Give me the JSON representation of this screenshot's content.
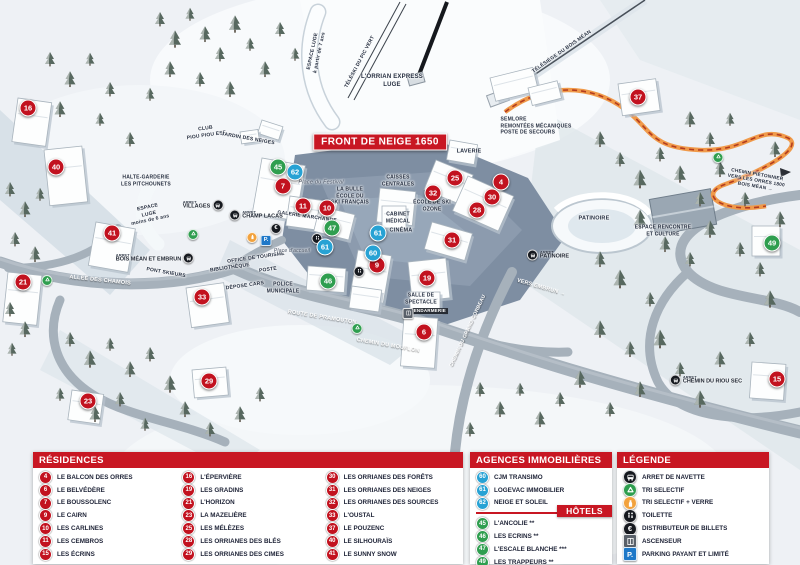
{
  "colors": {
    "residence": "#c2121f",
    "agency": "#27a2d4",
    "hotel": "#2f9e4f",
    "header_red": "#c81723",
    "icon_black": "#16191f",
    "icon_orange": "#f2a23d",
    "icon_grey": "#596069",
    "icon_parking_blue": "#1e78c8",
    "recycle_green": "#2f9e4f",
    "orange_path": "#f09a4a"
  },
  "map": {
    "banner": "FRONT DE NEIGE 1650",
    "arret_label": "ARRET",
    "markers": [
      {
        "num": "16",
        "type": "residence",
        "x": 28,
        "y": 108
      },
      {
        "num": "40",
        "type": "residence",
        "x": 56,
        "y": 167
      },
      {
        "num": "41",
        "type": "residence",
        "x": 112,
        "y": 233
      },
      {
        "num": "21",
        "type": "residence",
        "x": 23,
        "y": 282
      },
      {
        "num": "33",
        "type": "residence",
        "x": 202,
        "y": 297
      },
      {
        "num": "23",
        "type": "residence",
        "x": 88,
        "y": 401
      },
      {
        "num": "29",
        "type": "residence",
        "x": 209,
        "y": 381
      },
      {
        "num": "7",
        "type": "residence",
        "x": 283,
        "y": 186
      },
      {
        "num": "11",
        "type": "residence",
        "x": 303,
        "y": 206
      },
      {
        "num": "10",
        "type": "residence",
        "x": 327,
        "y": 208
      },
      {
        "num": "9",
        "type": "residence",
        "x": 377,
        "y": 265
      },
      {
        "num": "19",
        "type": "residence",
        "x": 427,
        "y": 278
      },
      {
        "num": "6",
        "type": "residence",
        "x": 424,
        "y": 332
      },
      {
        "num": "25",
        "type": "residence",
        "x": 455,
        "y": 178
      },
      {
        "num": "32",
        "type": "residence",
        "x": 433,
        "y": 193
      },
      {
        "num": "4",
        "type": "residence",
        "x": 501,
        "y": 182
      },
      {
        "num": "30",
        "type": "residence",
        "x": 492,
        "y": 197
      },
      {
        "num": "28",
        "type": "residence",
        "x": 477,
        "y": 210
      },
      {
        "num": "31",
        "type": "residence",
        "x": 452,
        "y": 240
      },
      {
        "num": "37",
        "type": "residence",
        "x": 638,
        "y": 97
      },
      {
        "num": "15",
        "type": "residence",
        "x": 777,
        "y": 379
      },
      {
        "num": "62",
        "type": "agency",
        "x": 295,
        "y": 172
      },
      {
        "num": "61",
        "type": "agency",
        "x": 378,
        "y": 233
      },
      {
        "num": "61",
        "type": "agency",
        "x": 325,
        "y": 247
      },
      {
        "num": "60",
        "type": "agency",
        "x": 373,
        "y": 253
      },
      {
        "num": "45",
        "type": "hotel",
        "x": 278,
        "y": 167
      },
      {
        "num": "47",
        "type": "hotel",
        "x": 332,
        "y": 228
      },
      {
        "num": "46",
        "type": "hotel",
        "x": 328,
        "y": 281
      },
      {
        "num": "49",
        "type": "hotel",
        "x": 772,
        "y": 243
      }
    ],
    "bus_stops": [
      {
        "name": "VILLAGES",
        "x": 203,
        "y": 205,
        "icon_side": "right"
      },
      {
        "name": "CHAMP LACAS",
        "x": 256,
        "y": 215,
        "icon_side": "left"
      },
      {
        "name": "BOIS MÉAN ET EMBRUN",
        "x": 155,
        "y": 258,
        "icon_side": "right"
      },
      {
        "name": "PATINOIRE",
        "x": 548,
        "y": 255,
        "icon_side": "left"
      },
      {
        "name": "CHEMIN DU RIOU SEC",
        "x": 706,
        "y": 380,
        "icon_side": "left"
      }
    ],
    "facilities": [
      {
        "icon": "recycle-icon",
        "x": 193,
        "y": 233
      },
      {
        "icon": "recycle-icon",
        "x": 47,
        "y": 279
      },
      {
        "icon": "recycle-icon",
        "x": 357,
        "y": 327
      },
      {
        "icon": "recycle-icon",
        "x": 718,
        "y": 156
      },
      {
        "icon": "glass-icon",
        "x": 252,
        "y": 236
      },
      {
        "icon": "parking-icon",
        "x": 266,
        "y": 237
      },
      {
        "icon": "atm-icon",
        "x": 276,
        "y": 225
      },
      {
        "icon": "toilet-icon",
        "x": 317,
        "y": 237
      },
      {
        "icon": "toilet-icon",
        "x": 359,
        "y": 270
      },
      {
        "icon": "elevator-icon",
        "x": 408,
        "y": 312
      }
    ],
    "labels": [
      {
        "text": "ESPACE LUGE\nà partir de 7 ans",
        "x": 316,
        "y": 52,
        "rot": -78,
        "cls": "",
        "size": 5
      },
      {
        "text": "TÉLÉSKI DU PIC VERT",
        "x": 360,
        "y": 62,
        "rot": -62,
        "cls": "",
        "size": 5
      },
      {
        "text": "L'ORRIAN EXPRESS\nLUGE",
        "x": 392,
        "y": 82,
        "rot": 0,
        "cls": "",
        "size": 6
      },
      {
        "text": "TÉLÉSIÈGE DU BOIS MÉAN",
        "x": 562,
        "y": 52,
        "rot": -35,
        "cls": "",
        "size": 5
      },
      {
        "text": "CLUB\nPIOU PIOU ESF",
        "x": 206,
        "y": 132,
        "rot": -8,
        "cls": "",
        "size": 5
      },
      {
        "text": "JARDIN DES NEIGES",
        "x": 248,
        "y": 139,
        "rot": 10,
        "cls": "",
        "size": 5
      },
      {
        "text": "HALTE-GARDERIE\nLES PITCHOUNETS",
        "x": 146,
        "y": 181,
        "rot": 0,
        "cls": "",
        "size": 5
      },
      {
        "text": "ESPACE\nLUGE\nmoins de 6 ans",
        "x": 149,
        "y": 214,
        "rot": -12,
        "cls": "",
        "size": 5
      },
      {
        "text": "Place du Festival",
        "x": 321,
        "y": 183,
        "rot": 0,
        "cls": "plain",
        "size": 5.5
      },
      {
        "text": "LA BULLE\nÉCOLE DU\nSKI FRANÇAIS",
        "x": 350,
        "y": 196,
        "rot": 0,
        "cls": "",
        "size": 5
      },
      {
        "text": "GALERIE MARCHANDE",
        "x": 307,
        "y": 217,
        "rot": 8,
        "cls": "",
        "size": 5
      },
      {
        "text": "CAISSES\nCENTRALES",
        "x": 398,
        "y": 181,
        "rot": 0,
        "cls": "",
        "size": 5
      },
      {
        "text": "LAVERIE",
        "x": 469,
        "y": 152,
        "rot": 0,
        "cls": "",
        "size": 5.5
      },
      {
        "text": "ÉCOLE DE SKI\nOZONE",
        "x": 432,
        "y": 206,
        "rot": 0,
        "cls": "",
        "size": 5
      },
      {
        "text": "CABINET\nMÉDICAL",
        "x": 398,
        "y": 218,
        "rot": 0,
        "cls": "",
        "size": 5
      },
      {
        "text": "CINÉMA",
        "x": 401,
        "y": 231,
        "rot": 0,
        "cls": "",
        "size": 5.5
      },
      {
        "text": "SEMLORE\nREMONTÉES MÉCANIQUES\nPOSTE DE SECOURS",
        "x": 536,
        "y": 126,
        "rot": 0,
        "cls": "al",
        "size": 5
      },
      {
        "text": "PATINOIRE",
        "x": 594,
        "y": 219,
        "rot": 0,
        "cls": "",
        "size": 5.5
      },
      {
        "text": "ESPACE RENCONTRE\nET CULTURE",
        "x": 663,
        "y": 231,
        "rot": 0,
        "cls": "",
        "size": 5
      },
      {
        "text": "CHEMIN PIÉTONNIER\nVERS LES ORRES 1800\nBOIS MÉAN →",
        "x": 756,
        "y": 182,
        "rot": 10,
        "cls": "",
        "size": 4.8
      },
      {
        "text": "PONT SKIEURS",
        "x": 166,
        "y": 273,
        "rot": 10,
        "cls": "",
        "size": 5
      },
      {
        "text": "ALLÉE DES CHAMOIS",
        "x": 100,
        "y": 281,
        "rot": 6,
        "cls": "white",
        "size": 5.5
      },
      {
        "text": "OFFICE DE TOURISME",
        "x": 256,
        "y": 258,
        "rot": -8,
        "cls": "",
        "size": 5
      },
      {
        "text": "BIBLIOTHÈQUE",
        "x": 230,
        "y": 268,
        "rot": -8,
        "cls": "",
        "size": 5
      },
      {
        "text": "POSTE",
        "x": 268,
        "y": 270,
        "rot": -8,
        "cls": "",
        "size": 5
      },
      {
        "text": "DÉPOSE CARS",
        "x": 245,
        "y": 286,
        "rot": -8,
        "cls": "",
        "size": 5
      },
      {
        "text": "POLICE\nMUNICIPALE",
        "x": 283,
        "y": 288,
        "rot": 0,
        "cls": "",
        "size": 5
      },
      {
        "text": "Place d'accueil",
        "x": 292,
        "y": 251,
        "rot": 0,
        "cls": "plain",
        "size": 5
      },
      {
        "text": "SALLE DE\nSPECTACLE",
        "x": 421,
        "y": 299,
        "rot": 0,
        "cls": "",
        "size": 5
      },
      {
        "text": "GENDARMERIE",
        "x": 428,
        "y": 311,
        "rot": 0,
        "cls": "on-dark",
        "size": 4.5
      },
      {
        "text": "ROUTE DE PRAMOUTON",
        "x": 322,
        "y": 318,
        "rot": 9,
        "cls": "white",
        "size": 5.5
      },
      {
        "text": "CHEMIN DU MOUFLON",
        "x": 388,
        "y": 346,
        "rot": 10,
        "cls": "white",
        "size": 5.5
      },
      {
        "text": "CHEMIN DU GRAND CORBEAU",
        "x": 468,
        "y": 331,
        "rot": -65,
        "cls": "white",
        "size": 5
      },
      {
        "text": "VERS EMBRUN →",
        "x": 541,
        "y": 288,
        "rot": 16,
        "cls": "white",
        "size": 5.5
      }
    ]
  },
  "legend": {
    "residences": {
      "title": "RÉSIDENCES",
      "columns": [
        [
          {
            "num": "4",
            "name": "LE BALCON DES ORRES"
          },
          {
            "num": "6",
            "name": "LE BELVÉDÈRE"
          },
          {
            "num": "7",
            "name": "LE BOUSSOLENC"
          },
          {
            "num": "9",
            "name": "LE CAIRN"
          },
          {
            "num": "10",
            "name": "LES CARLINES"
          },
          {
            "num": "11",
            "name": "LES CEMBROS"
          },
          {
            "num": "15",
            "name": "LES ÉCRINS"
          }
        ],
        [
          {
            "num": "16",
            "name": "L'ÉPERVIÈRE"
          },
          {
            "num": "19",
            "name": "LES GRADINS"
          },
          {
            "num": "21",
            "name": "L'HORIZON"
          },
          {
            "num": "23",
            "name": "LA MAZELIÈRE"
          },
          {
            "num": "25",
            "name": "LES MÉLÈZES"
          },
          {
            "num": "28",
            "name": "LES ORRIANES DES BLÉS"
          },
          {
            "num": "29",
            "name": "LES ORRIANES DES CIMES"
          }
        ],
        [
          {
            "num": "30",
            "name": "LES ORRIANES DES FORÊTS"
          },
          {
            "num": "31",
            "name": "LES ORRIANES DES NEIGES"
          },
          {
            "num": "32",
            "name": "LES ORRIANES DES SOURCES"
          },
          {
            "num": "33",
            "name": "L'OUSTAL"
          },
          {
            "num": "37",
            "name": "LE POUZENC"
          },
          {
            "num": "40",
            "name": "LE SILHOURAÏS"
          },
          {
            "num": "41",
            "name": "LE SUNNY SNOW"
          }
        ]
      ]
    },
    "agences": {
      "title": "AGENCES IMMOBILIÈRES",
      "items": [
        {
          "num": "60",
          "name": "CJM TRANSIMO"
        },
        {
          "num": "61",
          "name": "LOGEVAC IMMOBILIER"
        },
        {
          "num": "62",
          "name": "NEIGE ET SOLEIL"
        }
      ]
    },
    "hotels": {
      "title": "HÔTELS",
      "items": [
        {
          "num": "45",
          "name": "L'ANCOLIE **"
        },
        {
          "num": "46",
          "name": "LES ECRINS **"
        },
        {
          "num": "47",
          "name": "L'ESCALE BLANCHE ***"
        },
        {
          "num": "49",
          "name": "LES TRAPPEURS **"
        }
      ]
    },
    "legende": {
      "title": "LÉGENDE",
      "items": [
        {
          "icon": "bus-icon",
          "label": "ARRET DE NAVETTE"
        },
        {
          "icon": "recycle-icon",
          "label": "TRI SELECTIF"
        },
        {
          "icon": "glass-icon",
          "label": "TRI SELECTIF + VERRE"
        },
        {
          "icon": "toilet-icon",
          "label": "TOILETTE"
        },
        {
          "icon": "atm-icon",
          "label": "DISTRIBUTEUR DE BILLETS"
        },
        {
          "icon": "elevator-icon",
          "label": "ASCENSEUR"
        },
        {
          "icon": "parking-icon",
          "label": "PARKING PAYANT ET LIMITÉ"
        }
      ]
    }
  }
}
